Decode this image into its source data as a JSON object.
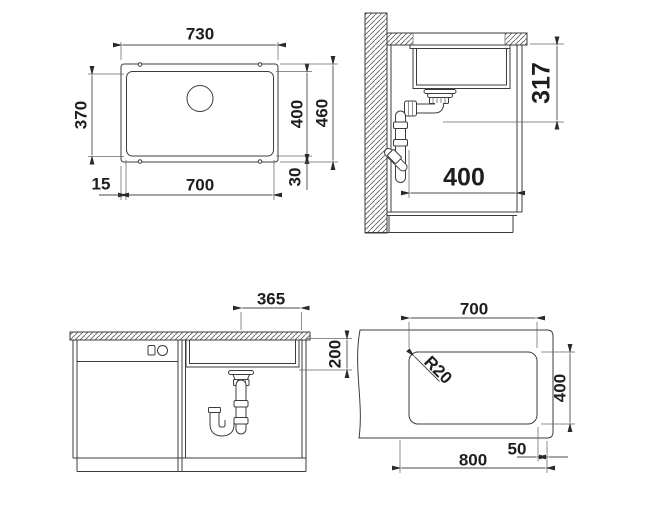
{
  "drawing": {
    "top_plan": {
      "outer_width": "730",
      "bowl_inner_depth": "370",
      "bowl_depth": "400",
      "outer_depth": "460",
      "rim_offset_bottom": "30",
      "rim_offset_left": "15",
      "bowl_width": "700"
    },
    "side_section": {
      "counter_to_drain_height": "317",
      "drain_to_front_distance": "400"
    },
    "front_section": {
      "drain_center_offset": "365",
      "bowl_height": "200"
    },
    "cutout_plan": {
      "cutout_width": "700",
      "corner_radius": "R20",
      "cutout_depth": "400",
      "edge_offset": "50",
      "cabinet_width": "800"
    },
    "colors": {
      "line": "#3c3c3c",
      "text": "#1e1e1e",
      "background": "#ffffff"
    }
  }
}
